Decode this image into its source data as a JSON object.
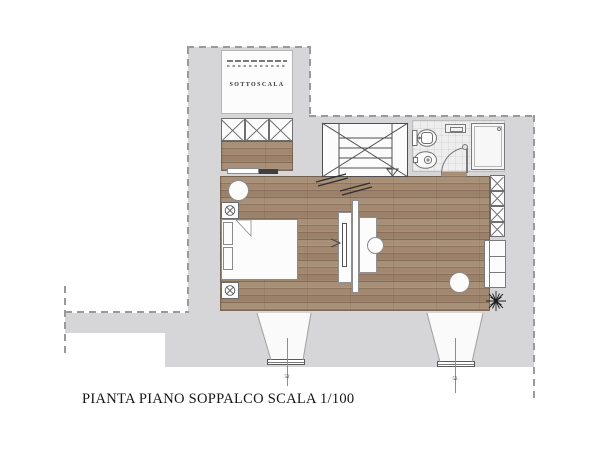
{
  "meta": {
    "caption": "PIANTA PIANO SOPPALCO SCALA 1/100",
    "drawing_type": "floor plan"
  },
  "rooms": {
    "sottoscala": {
      "label": "SOTTOSCALA"
    }
  },
  "windows": [
    {
      "mark": "52"
    },
    {
      "mark": "52"
    }
  ],
  "icons": {
    "stairs": "rectangle with X diagonals, treads and down arrow",
    "stair_arrow": "open triangle pointing down",
    "toilet": "tank + oval bowl",
    "bidet": "oval with tap",
    "shower": "square tray with head dot",
    "wardrobe_cell": "square with X",
    "plant": "starburst",
    "ceiling_lamp": "circle with X",
    "door_swing": "quarter arc"
  },
  "colors": {
    "wall": "#d6d5d7",
    "wood": "#a3886f",
    "wood_line": "#84705c",
    "tile": "#efeeef",
    "dash_line": "#9a9a9a",
    "furniture_fill": "#fcfcfc",
    "stair_line": "#4f4f4f",
    "fixture_line": "#767676",
    "text": "#151515"
  }
}
